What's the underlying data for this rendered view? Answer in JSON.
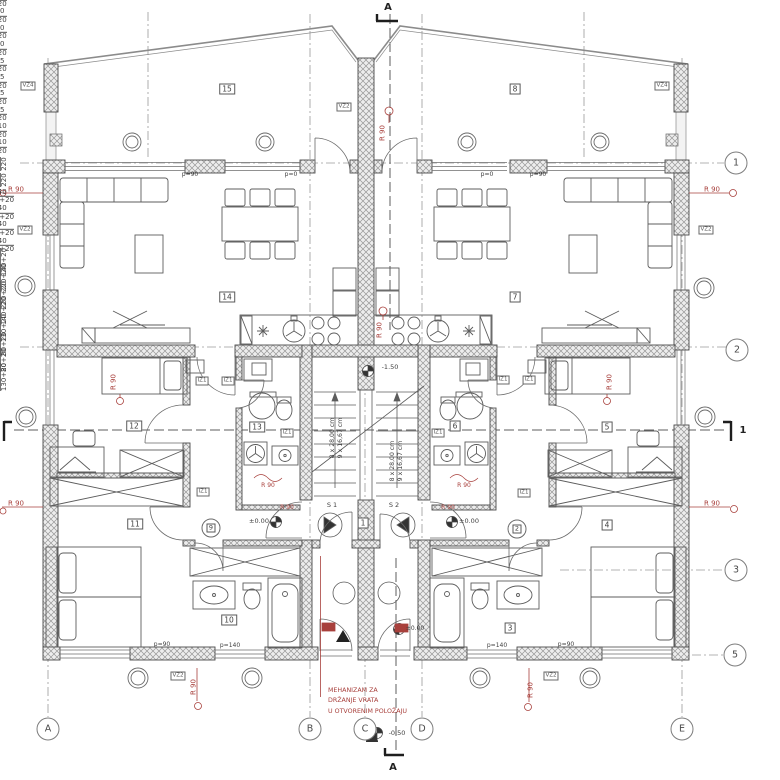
{
  "drawing": {
    "rooms": {
      "1": "1",
      "2": "2",
      "3": "3",
      "4": "4",
      "5": "5",
      "6": "6",
      "7": "7",
      "8": "8",
      "9": "9",
      "10": "10",
      "11": "11",
      "12": "12",
      "13": "13",
      "14": "14",
      "15": "15"
    },
    "grid": {
      "a": "A",
      "b": "B",
      "c": "C",
      "d": "D",
      "e": "E",
      "r1": "1",
      "r2": "2",
      "r3": "3",
      "r5": "5"
    },
    "sections": {
      "top": "A",
      "bottom": "A",
      "side": "1"
    },
    "levels": {
      "upper": "-1.50",
      "zero": "±0.00",
      "entry": "-0.50"
    },
    "stairs": {
      "s1": "S 1",
      "s2": "S 2",
      "run": "8 x 28,00 cm",
      "rise": "9 x 16,67 cm"
    },
    "dims": {
      "n90": "90",
      "n220": "220",
      "n75": "75",
      "n110": "110",
      "n140": "140",
      "n130": "130+20",
      "n300": "300",
      "n140p": "140+20",
      "n220p": "220+20",
      "n80": "80",
      "n80p": "80+20",
      "p90": "p=90",
      "p0": "p=0",
      "p140": "p=140"
    },
    "walls": {
      "vz4": "VZ4",
      "vz2": "VZ2",
      "iz1": "IZ1"
    },
    "notes": {
      "r90": "R 90",
      "mech1": "MEHANIZAM ZA",
      "mech2": "DRŽANJE VRATA",
      "mech3": "U OTVORENIM POLOŽAJU"
    },
    "colors": {
      "annotation_red": "#a8403c",
      "line": "#3f3f3f"
    }
  }
}
